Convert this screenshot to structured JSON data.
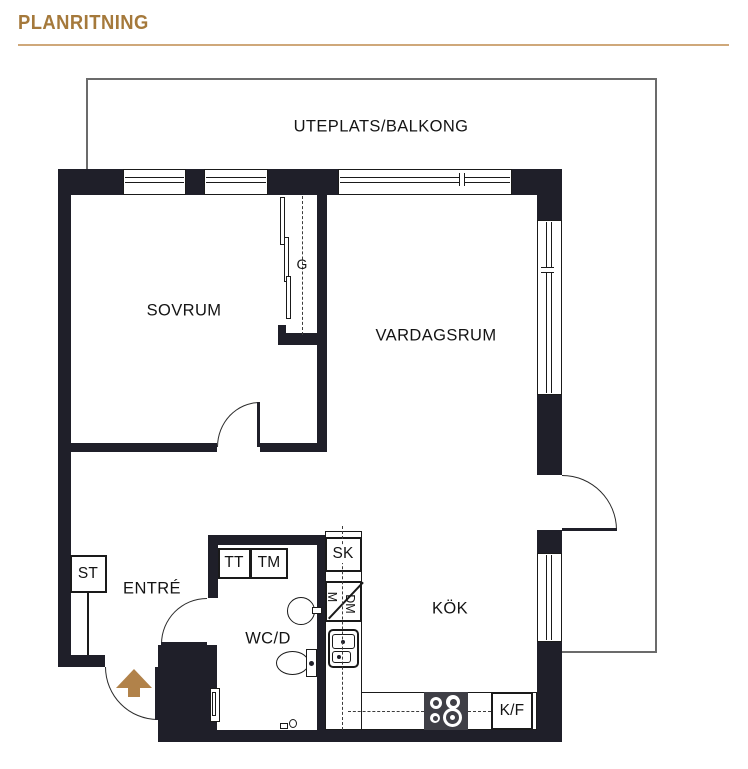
{
  "title": "PLANRITNING",
  "balcony": {
    "label": "UTEPLATS/BALKONG"
  },
  "rooms": {
    "sovrum": {
      "label": "SOVRUM"
    },
    "vardagsrum": {
      "label": "VARDAGSRUM"
    },
    "entre": {
      "label": "ENTRÉ"
    },
    "wcd": {
      "label": "WC/D"
    },
    "kok": {
      "label": "KÖK"
    }
  },
  "fixtures": {
    "st": {
      "label": "ST"
    },
    "tt": {
      "label": "TT"
    },
    "tm": {
      "label": "TM"
    },
    "sk": {
      "label": "SK"
    },
    "m": {
      "label": "M"
    },
    "dm": {
      "label": "DM"
    },
    "kf": {
      "label": "K/F"
    },
    "garderob": {
      "label": "G"
    }
  },
  "colors": {
    "accent": "#a5793b",
    "title_rule": "#cfa87a",
    "wall": "#1f1f29",
    "entry_arrow": "#b1824a",
    "balcony_line": "#6b6b6b"
  }
}
